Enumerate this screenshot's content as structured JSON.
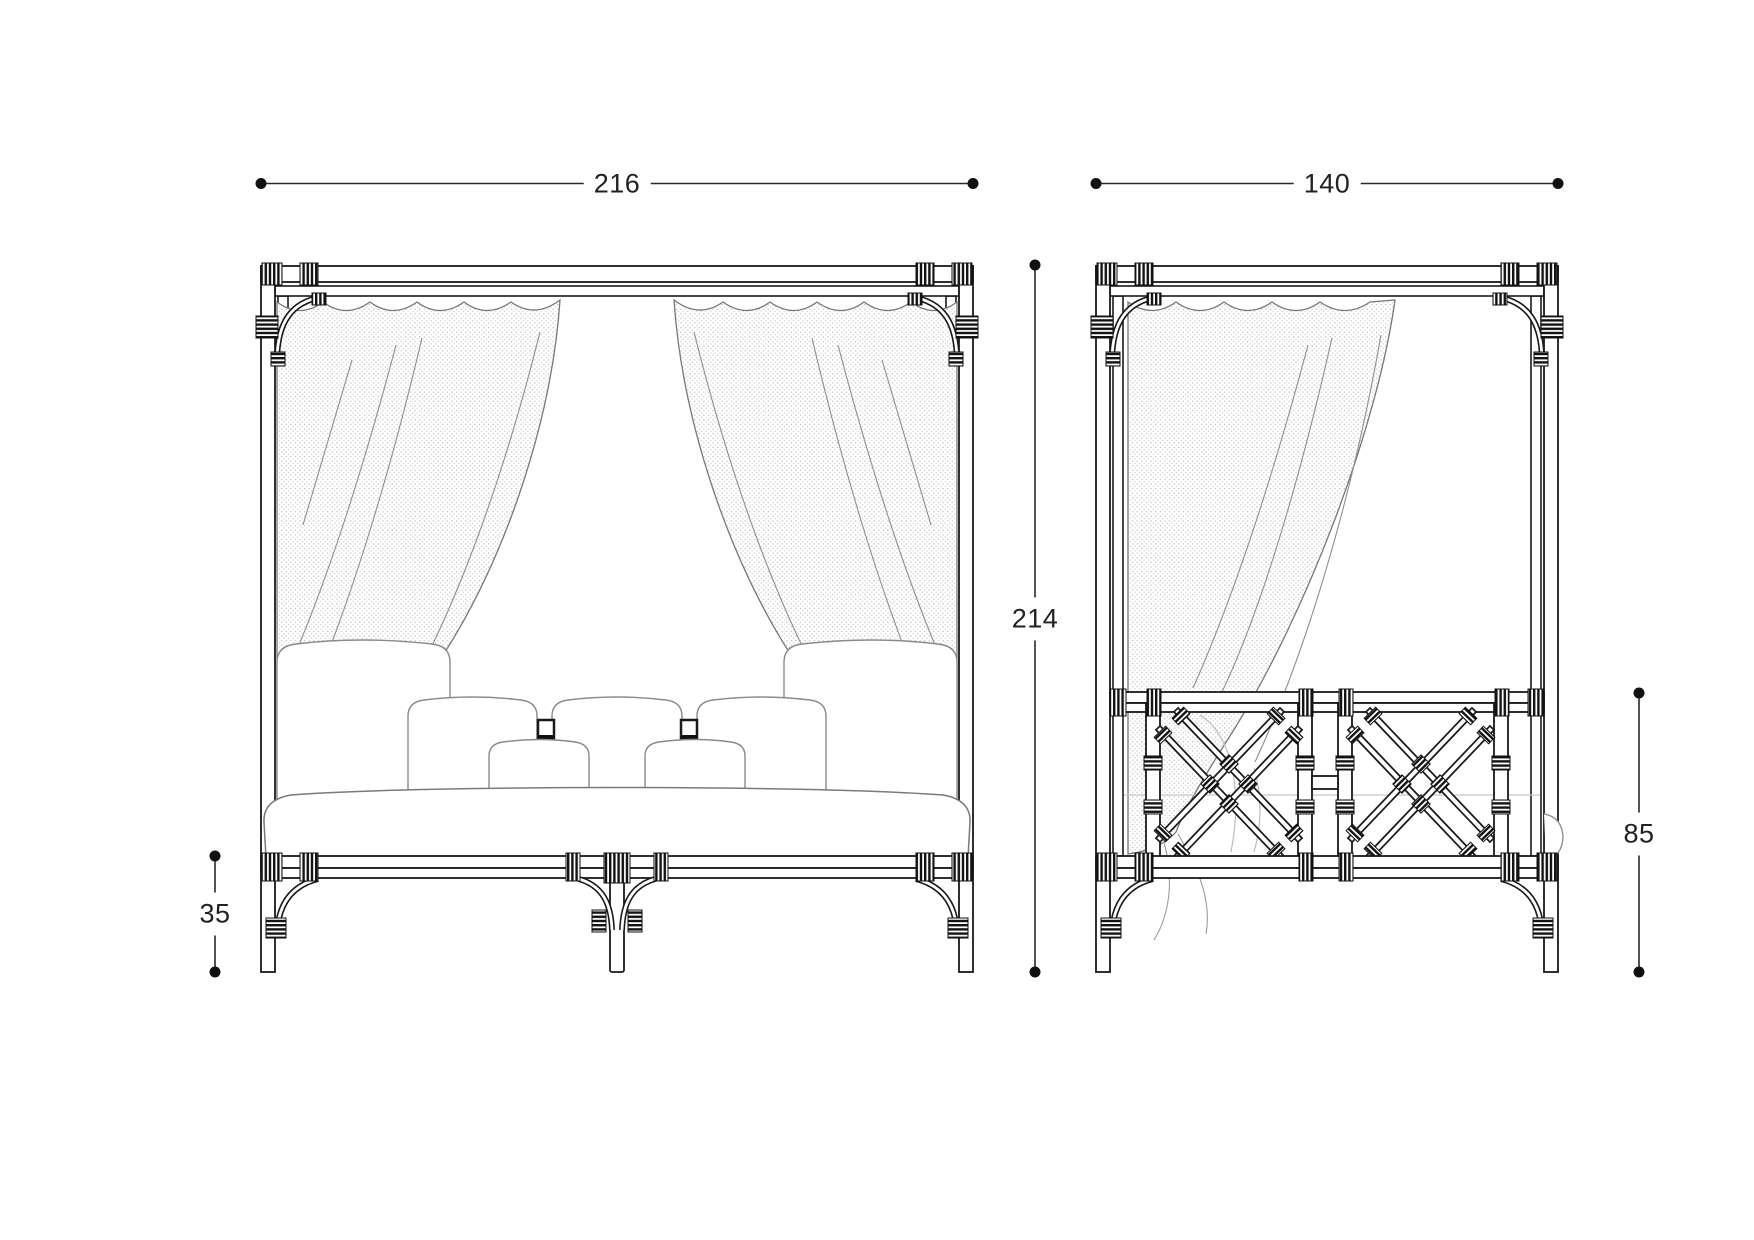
{
  "drawing_type": "furniture-technical-drawing",
  "views": {
    "left": "front-elevation",
    "right": "side-elevation"
  },
  "dimensions": {
    "front_width": "216",
    "side_depth": "140",
    "total_height": "214",
    "base_height": "35",
    "side_rail_height": "85"
  },
  "colors": {
    "background": "#ffffff",
    "frame_line": "#1a1a1a",
    "soft_goods_line": "#8a8a8a",
    "curtain_stipple": "#c6c6c6",
    "dimension_line": "#2a2a2a",
    "dimension_text": "#222222"
  }
}
